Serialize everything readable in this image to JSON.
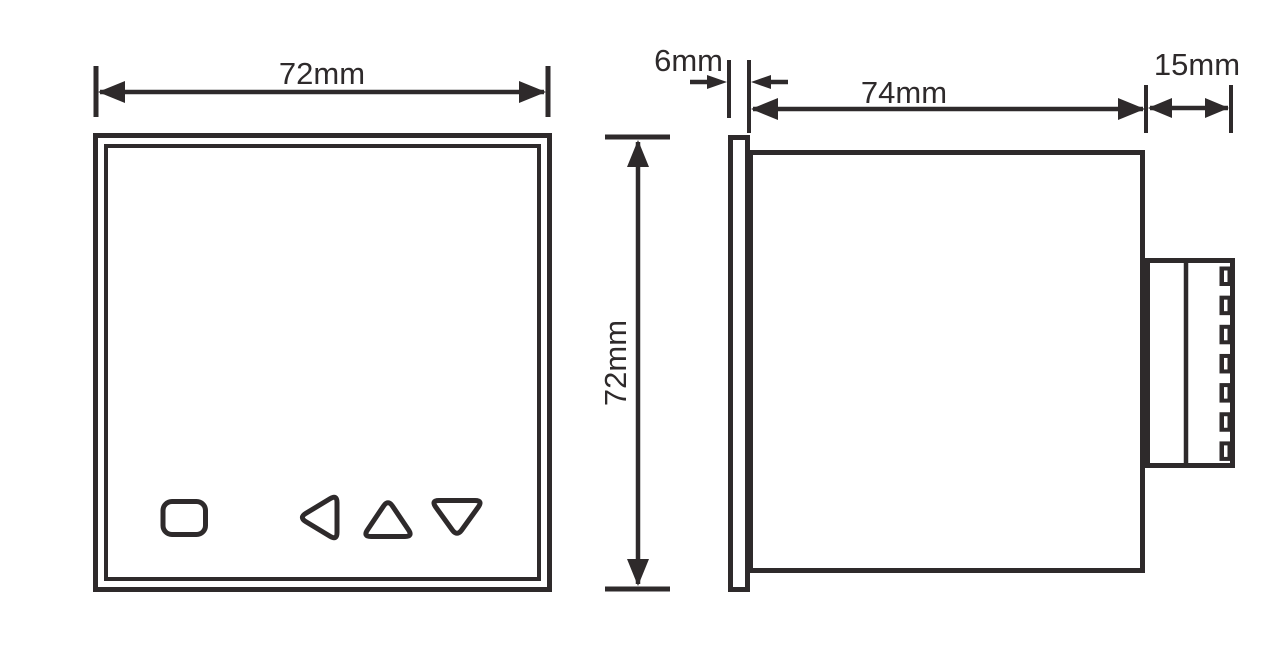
{
  "figure": {
    "ink_color": "#2e2a2b",
    "background_color": "#ffffff"
  },
  "front_view": {
    "width_dim": "72mm",
    "height_dim": "72mm"
  },
  "side_view": {
    "panel_depth_dim": "6mm",
    "body_depth_dim": "74mm",
    "terminal_depth_dim": "15mm",
    "terminal_screw_count": 7
  }
}
